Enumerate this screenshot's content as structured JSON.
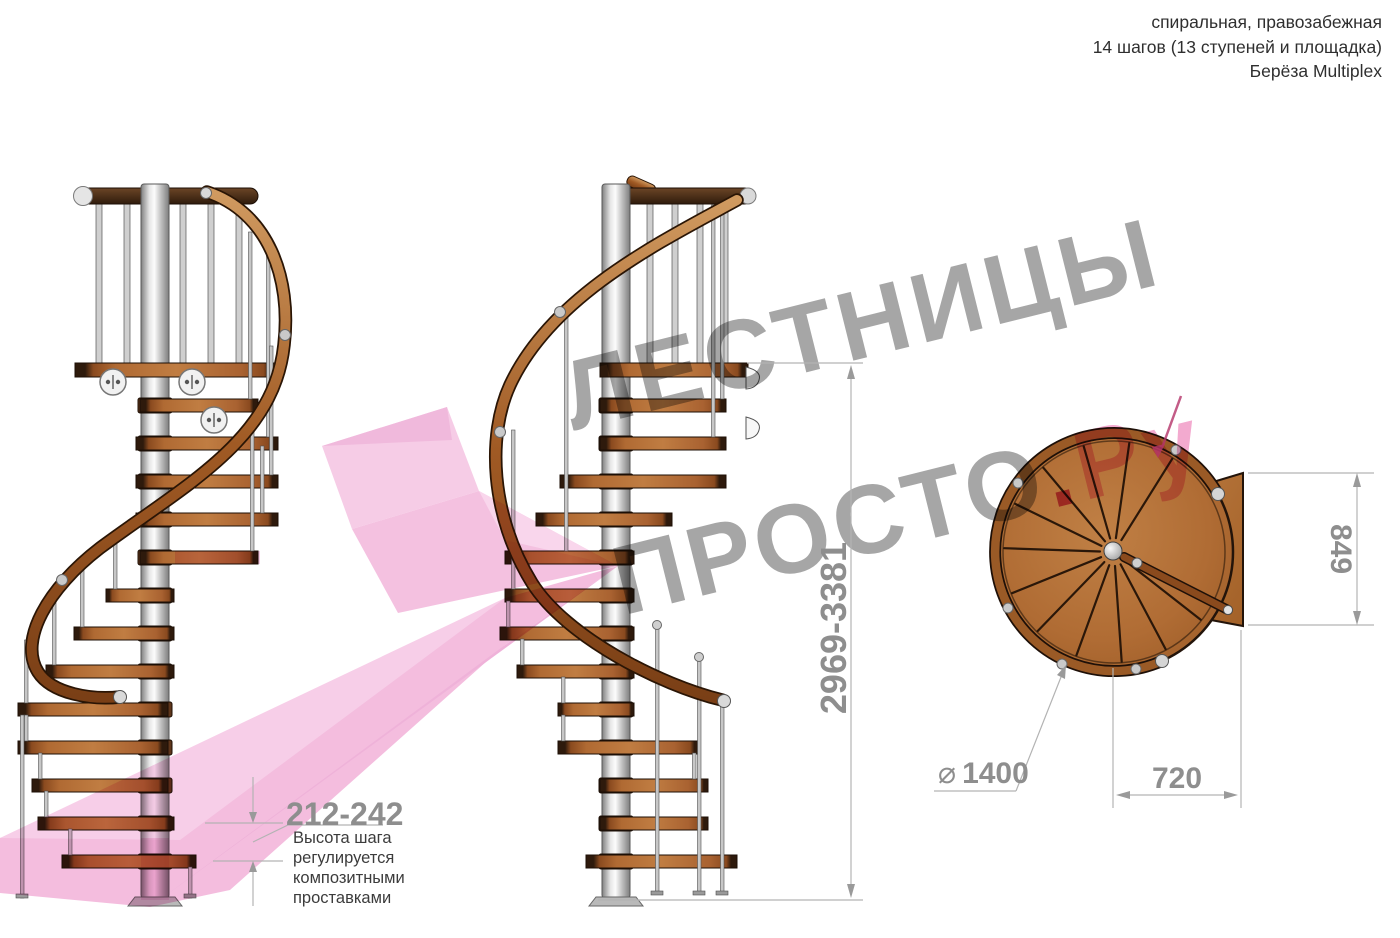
{
  "header": {
    "line1": "спиральная, правозабежная",
    "line2": "14 шагов (13 ступеней и площадка)",
    "line3": "Берёза Multiplex"
  },
  "watermark": {
    "line1": "ЛЕСТНИЦЫ",
    "line2_gray": "ПРОСТО",
    "line2_dot": ".",
    "line2_pink": "Ру"
  },
  "dimensions": {
    "step_height": "212-242",
    "step_note_lines": [
      "Высота шага",
      "регулируется",
      "композитными",
      "проставками"
    ],
    "total_height": "2969-3381",
    "platform_side": "849",
    "passage_width": "720",
    "diameter_symbol": "⌀",
    "diameter_value": "1400"
  },
  "colors": {
    "wood": "#b06a33",
    "metal": "#c4c4c4",
    "watermark_gray": "#9e9e9e",
    "watermark_pink": "#f2a3cb",
    "accent_pink": "#f3b6db",
    "dimension_gray": "#8e8e8e"
  }
}
